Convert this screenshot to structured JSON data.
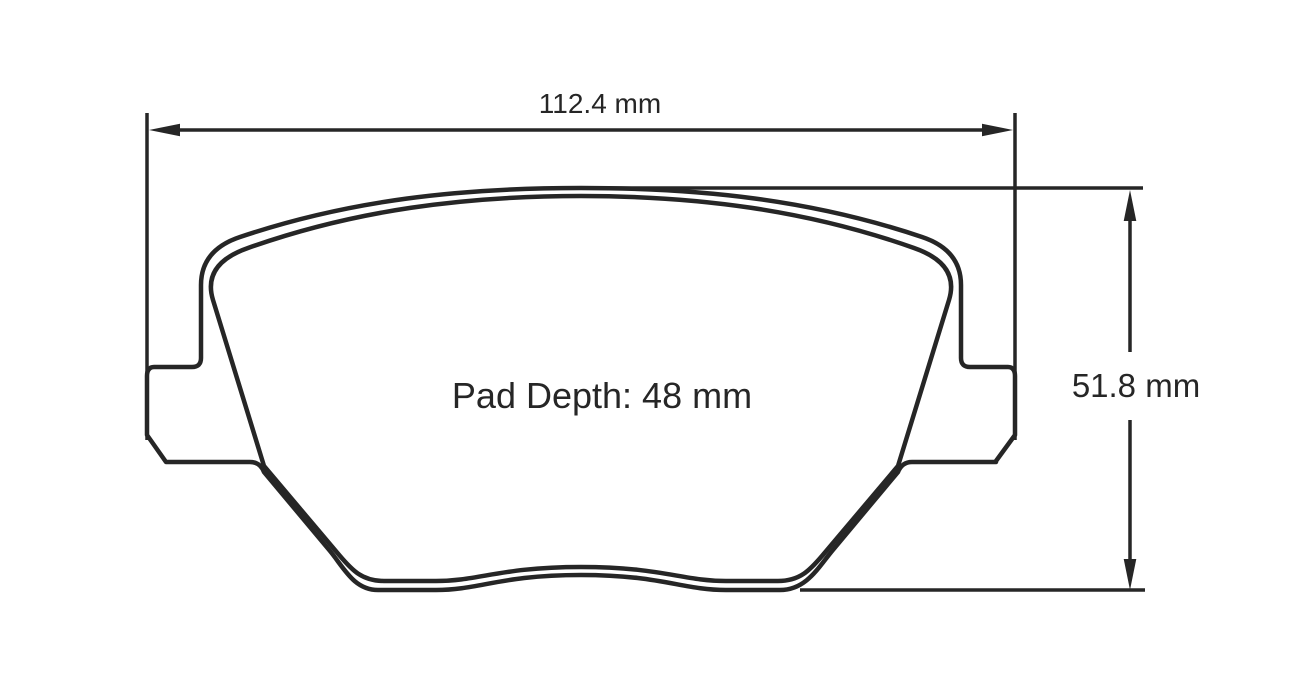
{
  "diagram": {
    "type": "technical-drawing",
    "description": "brake pad outline, friction-surface view, with overall dimensions",
    "background_color": "#ffffff",
    "line_color": "#262626",
    "labels": {
      "width": "112.4 mm",
      "height": "51.8 mm",
      "pad_depth": "Pad Depth: 48 mm"
    },
    "values": {
      "width_mm": 112.4,
      "height_mm": 51.8,
      "pad_depth_mm": 48
    }
  }
}
